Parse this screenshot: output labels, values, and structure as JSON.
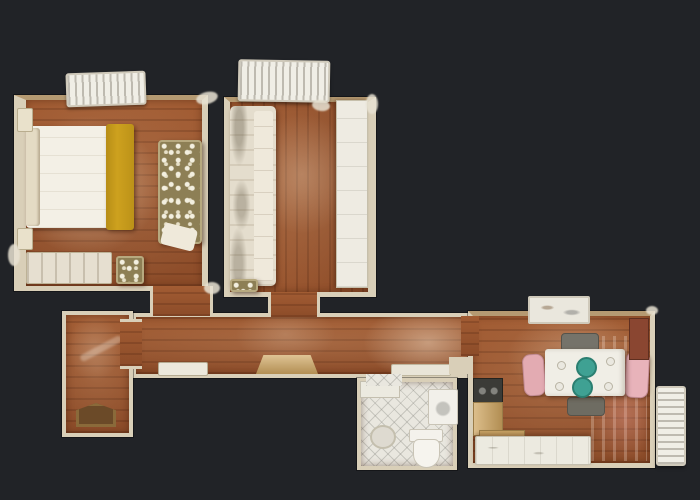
{
  "scene": {
    "type": "3d-dollhouse-floorplan",
    "description": "Top-down photogrammetric (dollhouse) floor plan of a one-bedroom apartment rendered on a dark charcoal background; no visible text in the image",
    "background_color": "#212327"
  },
  "palette": {
    "background": "#212327",
    "wall_cream": "#d9cfb8",
    "wood_floor": "#9a5630",
    "bed_duvet_white": "#f3f0e6",
    "bed_runner_yellow": "#cda11e",
    "floral_upholstery_olive": "#8d7f55",
    "sofa_cream": "#e4ddcd",
    "bathroom_tile_white": "#e9e7df",
    "dining_table_white": "#f0eee6",
    "chair_pink": "#e3abb2",
    "plate_teal": "#3fa193",
    "kitchen_counter_tan": "#c9a365",
    "stove_dark": "#3b3b37",
    "doormat_brown": "#6b4a28",
    "radiator_white": "#f0eee6"
  },
  "rooms": [
    {
      "id": "bedroom",
      "name": "Bedroom",
      "furniture": [
        "double bed with white duvet and mustard-yellow runner",
        "headboard pillows",
        "floral olive loveseat",
        "floral ottoman",
        "low dresser bench",
        "two nightstands",
        "window radiator"
      ]
    },
    {
      "id": "living-room",
      "name": "Living room",
      "furniture": [
        "long cream sofa along left wall",
        "white wardrobe along right wall",
        "floral pouf",
        "window radiator"
      ]
    },
    {
      "id": "hallway",
      "name": "Hallway",
      "furniture": [
        "tan half-round console rug",
        "white door panel",
        "low shelf"
      ]
    },
    {
      "id": "entry-hall",
      "name": "Entry hall",
      "furniture": [
        "brown doormat at entrance door",
        "light reflection on floor"
      ]
    },
    {
      "id": "bathroom",
      "name": "Bathroom",
      "furniture": [
        "sink counter",
        "washing machine",
        "toilet",
        "round floor mat",
        "diamond-pattern tile floor"
      ]
    },
    {
      "id": "kitchen-dining",
      "name": "Kitchen & dining room",
      "furniture": [
        "white dining table",
        "two teal plates",
        "four small plates",
        "pink chair left",
        "pink chair right",
        "dark chair top",
        "dark chair bottom",
        "dark red cabinet",
        "stove hob",
        "tan cabinets",
        "white bottom counter",
        "window light streaks on floor",
        "window sill box",
        "wall radiator"
      ]
    }
  ]
}
